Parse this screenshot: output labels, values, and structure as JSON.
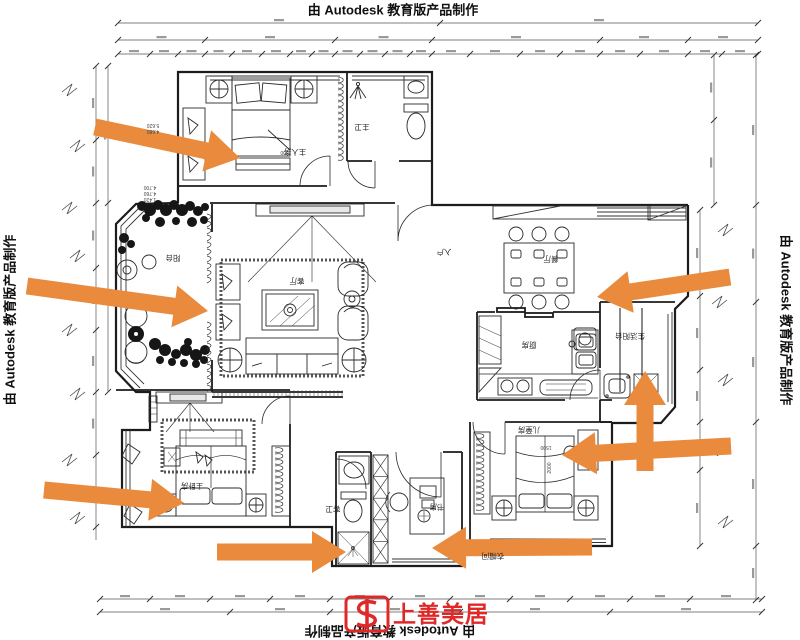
{
  "watermark": {
    "text": "由 Autodesk 教育版产品制作"
  },
  "logo": {
    "name": "上善美居"
  },
  "colors": {
    "arrow": "#E98A3C",
    "logo_red": "#E02828",
    "ink": "#1F1F1F"
  },
  "rooms": {
    "master_top": {
      "label": "主人房"
    },
    "master_bath": {
      "label": "主卫"
    },
    "living": {
      "label": "客厅"
    },
    "entry": {
      "label": "入户"
    },
    "dining": {
      "label": "餐厅"
    },
    "kitchen": {
      "label": "厨房"
    },
    "utility_balcony": {
      "label": "生活阳台"
    },
    "balcony": {
      "label": "阳台"
    },
    "master_bottom": {
      "label": "主卧房"
    },
    "guest_bath": {
      "label": "客卫"
    },
    "study": {
      "label": "书房"
    },
    "kids": {
      "label": "儿童房"
    },
    "cloak": {
      "label": "衣帽间"
    }
  },
  "annotations": {
    "elev1": "5.620",
    "elev2": "4.680",
    "elev3": "4.700",
    "elev4": "4.760",
    "elev5": "1.420",
    "dim_bed_master": "1800",
    "dim_bed_kids_w": "1500",
    "dim_bed_kids_l": "2000"
  },
  "arrows": [
    {
      "x1": 95,
      "y1": 127,
      "x2": 240,
      "y2": 158
    },
    {
      "x1": 27,
      "y1": 286,
      "x2": 208,
      "y2": 311
    },
    {
      "x1": 44,
      "y1": 490,
      "x2": 184,
      "y2": 503
    },
    {
      "x1": 217,
      "y1": 552,
      "x2": 346,
      "y2": 552
    },
    {
      "x1": 592,
      "y1": 547,
      "x2": 432,
      "y2": 548
    },
    {
      "x1": 731,
      "y1": 446,
      "x2": 562,
      "y2": 455
    },
    {
      "x1": 645,
      "y1": 471,
      "x2": 645,
      "y2": 371
    },
    {
      "x1": 730,
      "y1": 277,
      "x2": 597,
      "y2": 297
    }
  ]
}
